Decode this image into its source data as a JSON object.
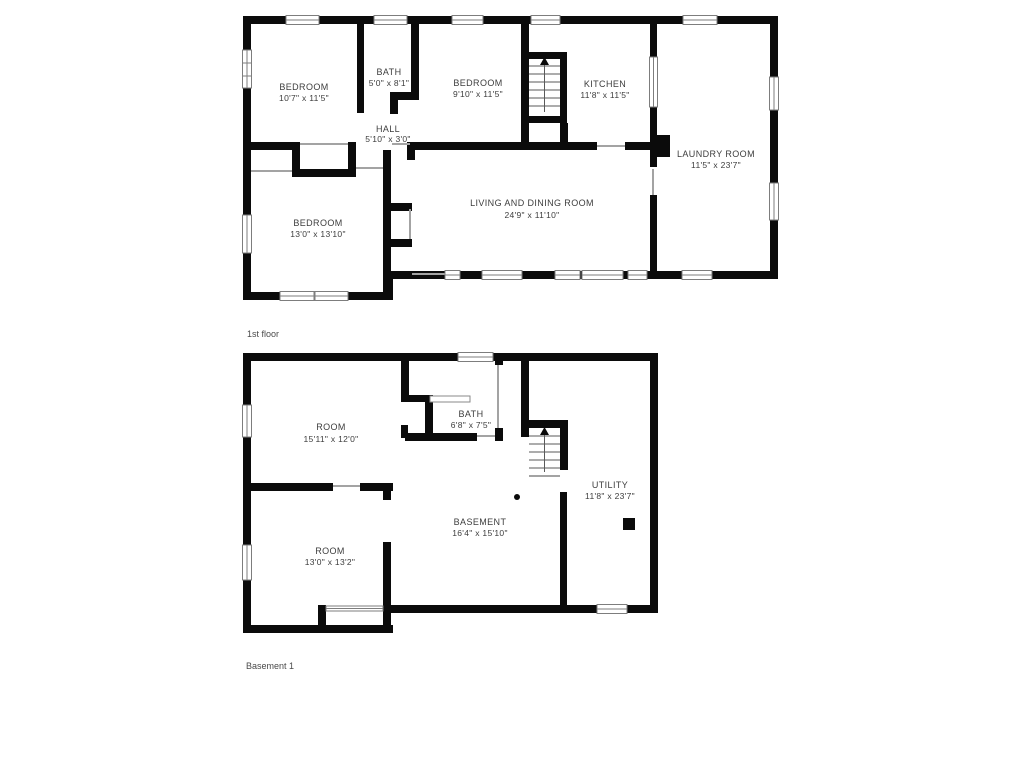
{
  "page": {
    "background": "#ffffff",
    "wall_color": "#0b0b0b",
    "text_color": "#3d3d3d"
  },
  "floors": [
    {
      "title": "1st floor",
      "rooms": [
        {
          "name": "BEDROOM",
          "dims": "10'7\" x 11'5\""
        },
        {
          "name": "BATH",
          "dims": "5'0\" x 8'1\""
        },
        {
          "name": "BEDROOM",
          "dims": "9'10\" x 11'5\""
        },
        {
          "name": "KITCHEN",
          "dims": "11'8\" x 11'5\""
        },
        {
          "name": "HALL",
          "dims": "5'10\" x 3'0\""
        },
        {
          "name": "LAUNDRY ROOM",
          "dims": "11'5\" x 23'7\""
        },
        {
          "name": "LIVING AND DINING ROOM",
          "dims": "24'9\" x 11'10\""
        },
        {
          "name": "BEDROOM",
          "dims": "13'0\" x 13'10\""
        }
      ]
    },
    {
      "title": "Basement 1",
      "rooms": [
        {
          "name": "ROOM",
          "dims": "15'11\" x 12'0\""
        },
        {
          "name": "BATH",
          "dims": "6'8\" x 7'5\""
        },
        {
          "name": "UTILITY",
          "dims": "11'8\" x 23'7\""
        },
        {
          "name": "BASEMENT",
          "dims": "16'4\" x 15'10\""
        },
        {
          "name": "ROOM",
          "dims": "13'0\" x 13'2\""
        }
      ]
    }
  ]
}
